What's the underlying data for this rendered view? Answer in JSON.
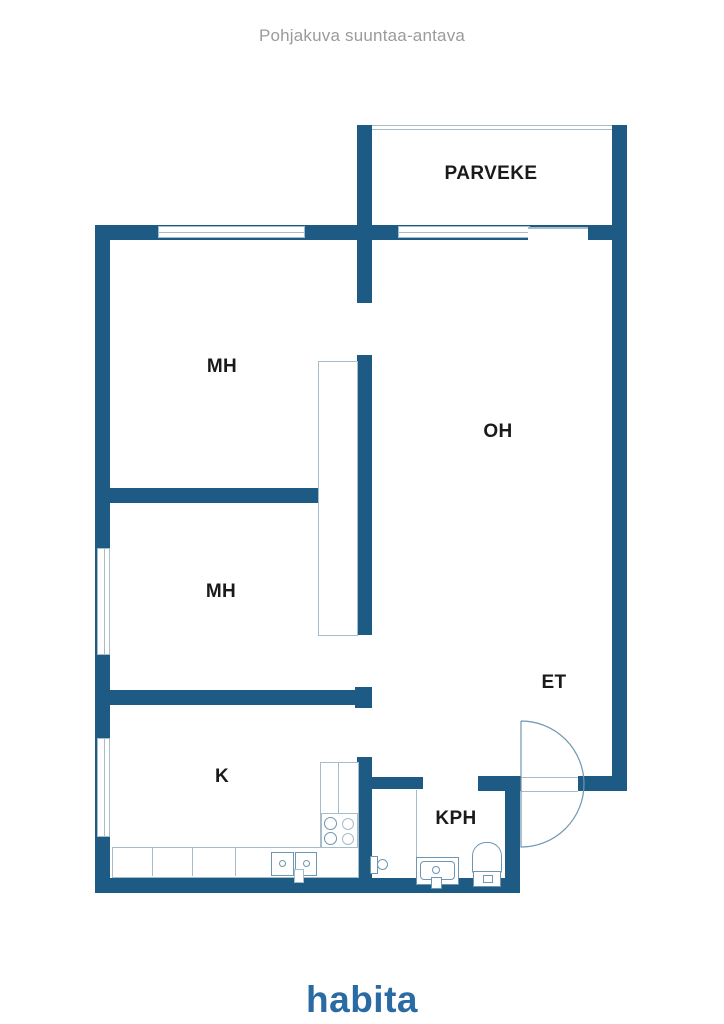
{
  "header": {
    "title": "Pohjakuva suuntaa-antava"
  },
  "plan": {
    "type": "floorplan",
    "rooms": {
      "parveke": {
        "label": "PARVEKE"
      },
      "mh1": {
        "label": "MH"
      },
      "mh2": {
        "label": "MH"
      },
      "oh": {
        "label": "OH"
      },
      "et": {
        "label": "ET"
      },
      "k": {
        "label": "K"
      },
      "kph": {
        "label": "KPH"
      }
    }
  },
  "branding": {
    "logo_text": "habita"
  },
  "colors": {
    "wall": "#1d5b85",
    "outline": "#a6bcc9",
    "fixture_line": "#6f96b0",
    "label": "#1a1a1a",
    "title": "#9b9b9b",
    "logo": "#2a6ba3"
  }
}
